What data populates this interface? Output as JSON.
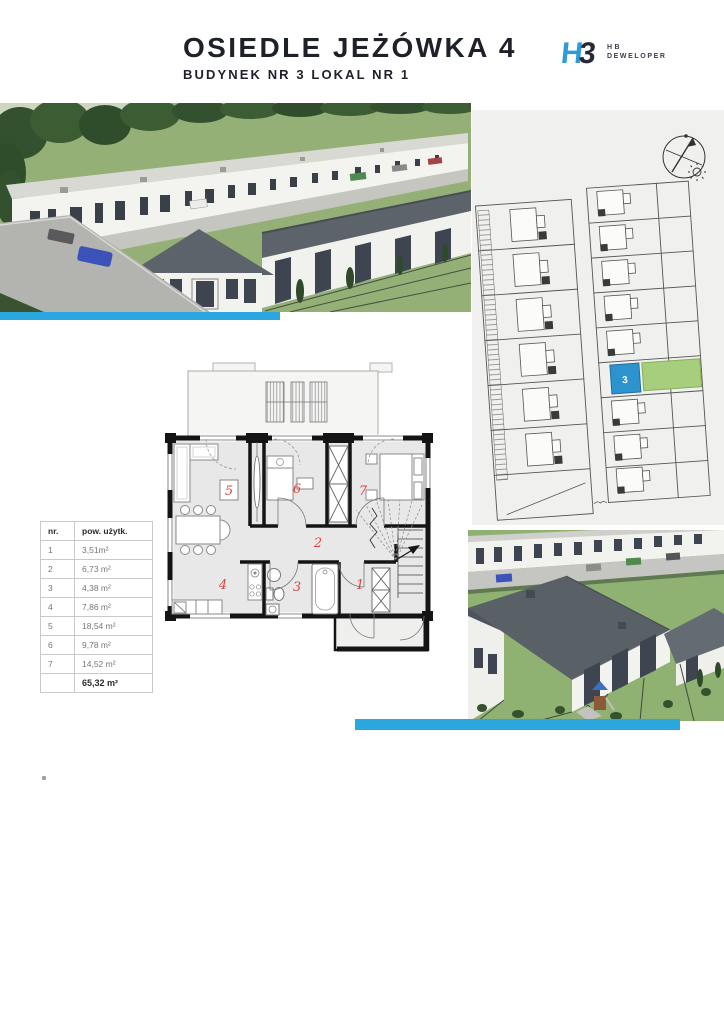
{
  "header": {
    "title": "OSIEDLE JEŻÓWKA 4",
    "subtitle": "BUDYNEK NR 3 LOKAL NR 1",
    "logo": {
      "mark_h": "H",
      "mark_b": "3",
      "line1": "HB",
      "line2": "DEWELOPER"
    }
  },
  "site_plan": {
    "highlighted_unit": "3"
  },
  "floor_plan": {
    "room_labels": [
      "1",
      "2",
      "3",
      "4",
      "5",
      "6",
      "7"
    ]
  },
  "area_table": {
    "col_nr": "nr.",
    "col_area": "pow. użytk.",
    "rows": [
      {
        "nr": "1",
        "area": "3,51m²"
      },
      {
        "nr": "2",
        "area": "6,73 m²"
      },
      {
        "nr": "3",
        "area": "4,38 m²"
      },
      {
        "nr": "4",
        "area": "7,86 m²"
      },
      {
        "nr": "5",
        "area": "18,54 m²"
      },
      {
        "nr": "6",
        "area": "9,78 m²"
      },
      {
        "nr": "7",
        "area": "14,52 m²"
      }
    ],
    "total": "65,32 m²"
  },
  "colors": {
    "accent_blue": "#2AA7DF",
    "unit_blue": "#2C93CF",
    "garden_green": "#A6CE7D",
    "panel_bg": "#F0F0EE",
    "room_number_red": "#DB4442",
    "title_dark": "#1F2128",
    "logo_blue": "#2E9AD6"
  }
}
